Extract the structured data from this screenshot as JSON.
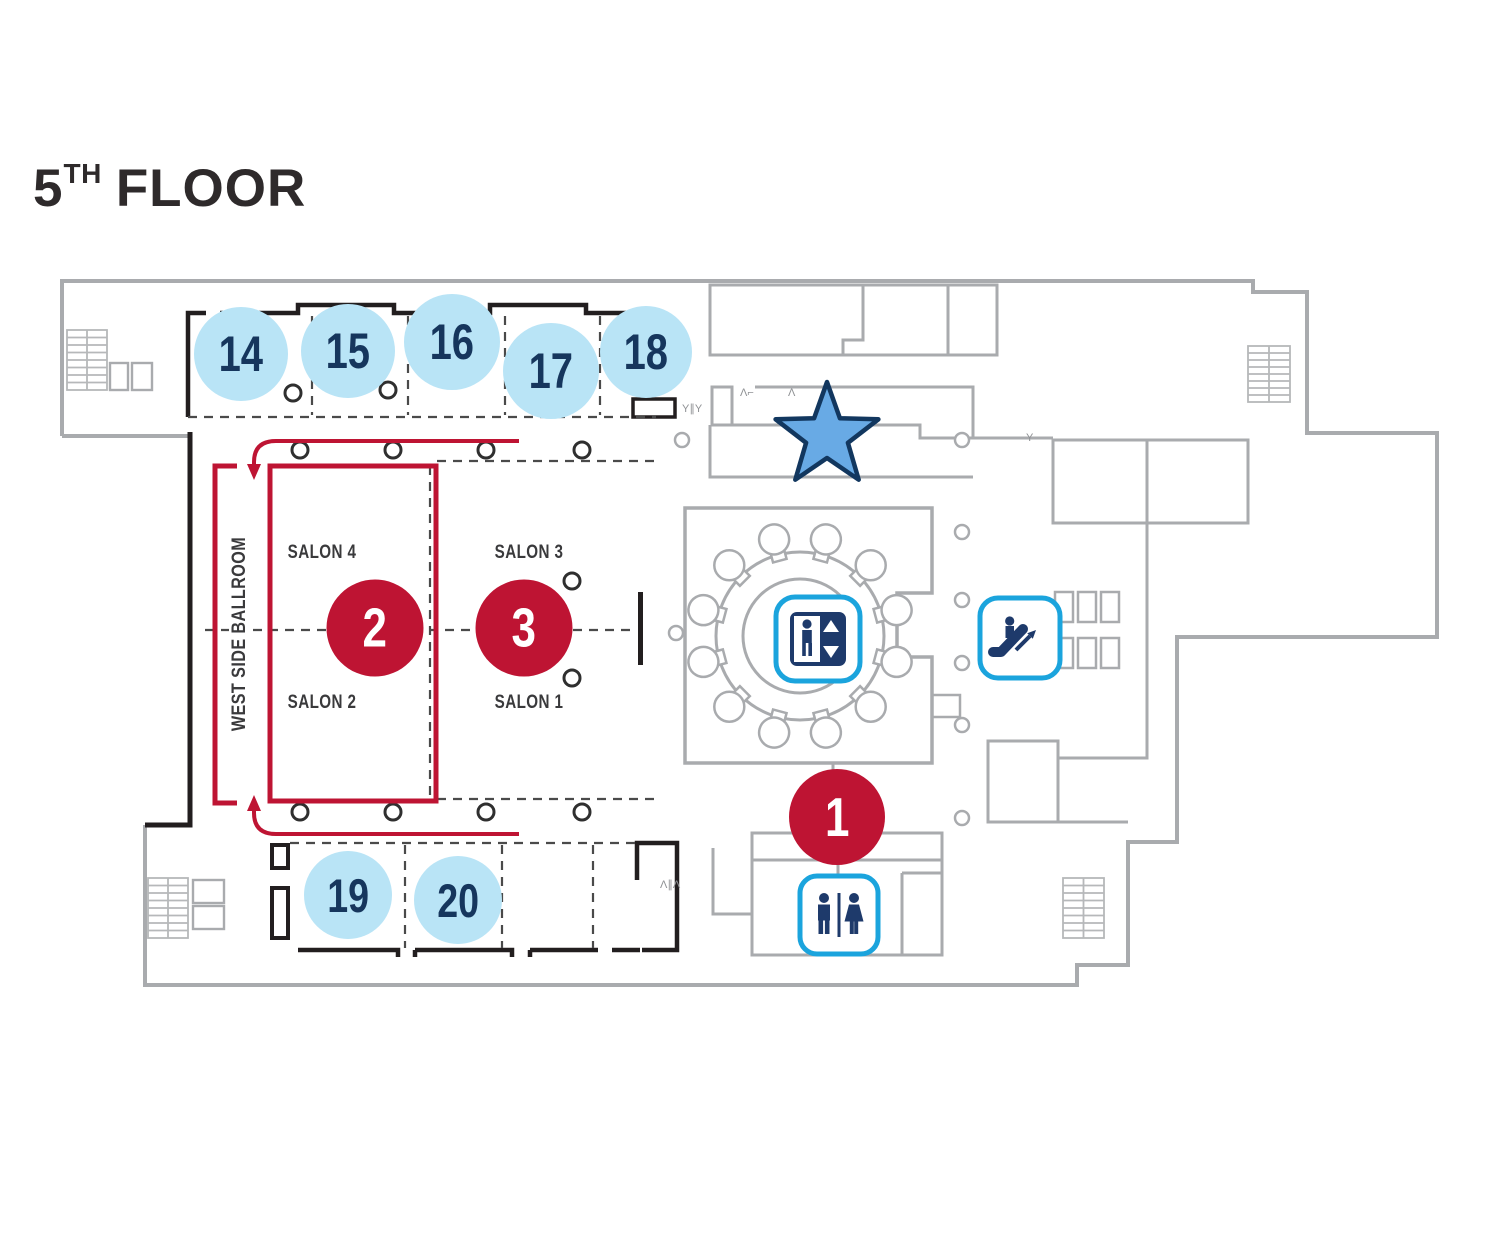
{
  "title": {
    "number": "5",
    "suffix": "TH",
    "word": "FLOOR"
  },
  "rooms": {
    "ballroom_label": "WEST SIDE BALLROOM",
    "salons": [
      {
        "name": "SALON 4"
      },
      {
        "name": "SALON 3"
      },
      {
        "name": "SALON 2"
      },
      {
        "name": "SALON 1"
      }
    ]
  },
  "markers": {
    "blue_session_rooms": [
      "14",
      "15",
      "16",
      "17",
      "18",
      "19",
      "20"
    ],
    "red_locations": [
      "1",
      "2",
      "3"
    ]
  },
  "icons": {
    "elevator": "elevator-icon",
    "escalator": "escalator-icon",
    "restroom": "restroom-icon",
    "star": "star-location-marker"
  },
  "door_marks": [
    "Λ⌐",
    "Λ",
    "Y∥Y",
    "Y",
    "Λ∥Λ"
  ],
  "colors": {
    "accent_red": "#be1433",
    "marker_blue_fill": "#b9e4f6",
    "marker_number_navy": "#16365d",
    "icon_border_cyan": "#1ba4dd",
    "icon_glyph_navy": "#1e3a6b",
    "star_fill": "#68aae5",
    "star_border": "#12375f",
    "wall_gray": "#a9abae",
    "wall_black": "#221e1f",
    "dashed_line": "#4a4a4a",
    "title_color": "#2e2a2b"
  }
}
